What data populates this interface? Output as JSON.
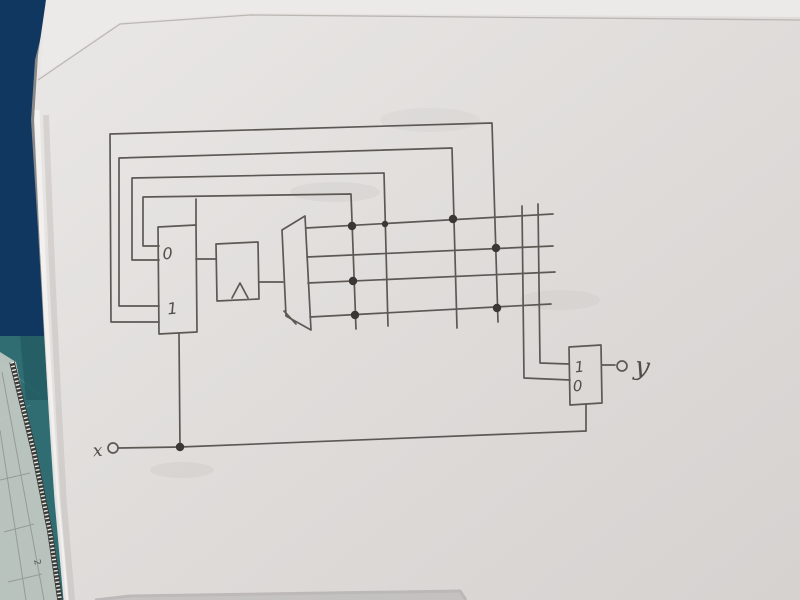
{
  "colors": {
    "desk": "#10375f",
    "mat": "#2f6d72",
    "mat_shade": "#235a62",
    "ruler_body": "#c9ccc6",
    "ruler_edge": "#3a3a38",
    "paper_light": "#e9e7e5",
    "paper_dark": "#d6d3d1",
    "back_sheet": "#eceae8",
    "paper_edge_line": "#b5b1ae",
    "pencil": "#5c5955",
    "junction_dot": "#3a3734"
  },
  "labels": {
    "state_selector_top": "0",
    "state_selector_bottom": "1",
    "register_clock": "∧",
    "output_selector_top": "1",
    "output_selector_bottom": "0",
    "input_signal": "x",
    "output_signal": "y",
    "ruler_mark": "2"
  }
}
